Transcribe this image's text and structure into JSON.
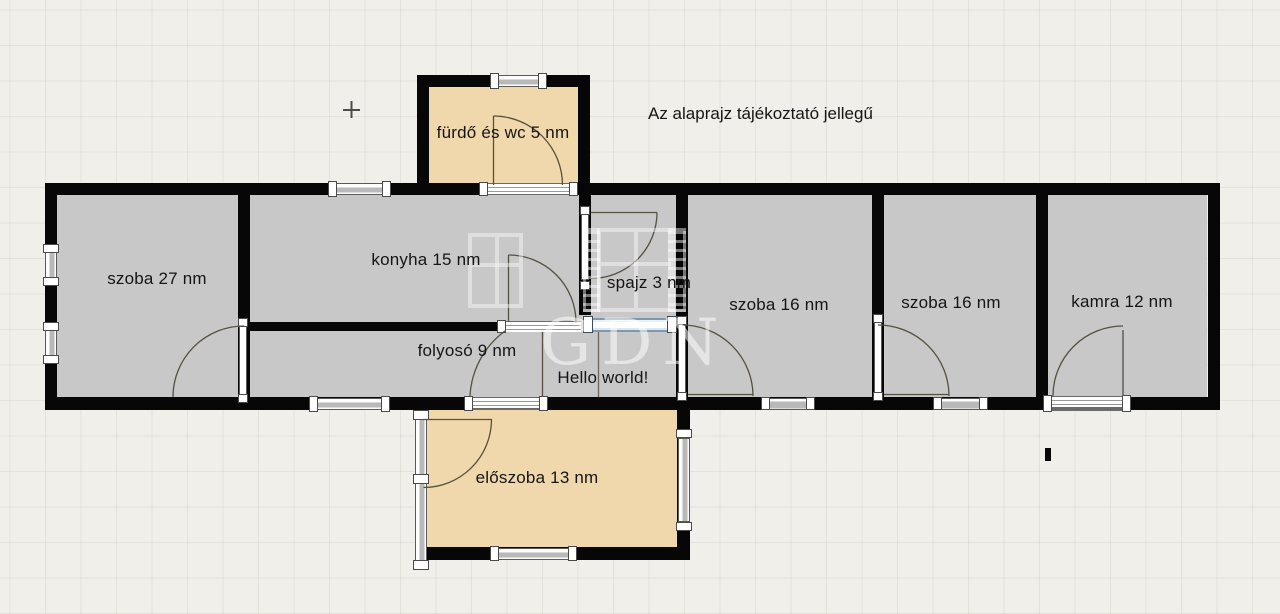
{
  "plan": {
    "disclaimer": "Az alaprajz tájékoztató jellegű",
    "note": "Hello world!",
    "watermark": "GDN",
    "rooms": [
      {
        "id": "furdo",
        "label": "fürdő és wc 5 nm",
        "area_nm": 5
      },
      {
        "id": "szoba27",
        "label": "szoba 27 nm",
        "area_nm": 27
      },
      {
        "id": "konyha",
        "label": "konyha 15 nm",
        "area_nm": 15
      },
      {
        "id": "spajz",
        "label": "spajz 3 nm",
        "area_nm": 3
      },
      {
        "id": "folyoso",
        "label": "folyosó 9 nm",
        "area_nm": 9
      },
      {
        "id": "szoba16a",
        "label": "szoba 16 nm",
        "area_nm": 16
      },
      {
        "id": "szoba16b",
        "label": "szoba 16 nm",
        "area_nm": 16
      },
      {
        "id": "kamra",
        "label": "kamra 12 nm",
        "area_nm": 12
      },
      {
        "id": "eloszoba",
        "label": "előszoba 13 nm",
        "area_nm": 13
      }
    ],
    "colors": {
      "wall": "#070707",
      "room_fill": "#c8c8c8",
      "warm_room_fill": "#f0d8ac",
      "selected_wall_accent": "#7e99ae",
      "background": "#f0efea"
    }
  }
}
